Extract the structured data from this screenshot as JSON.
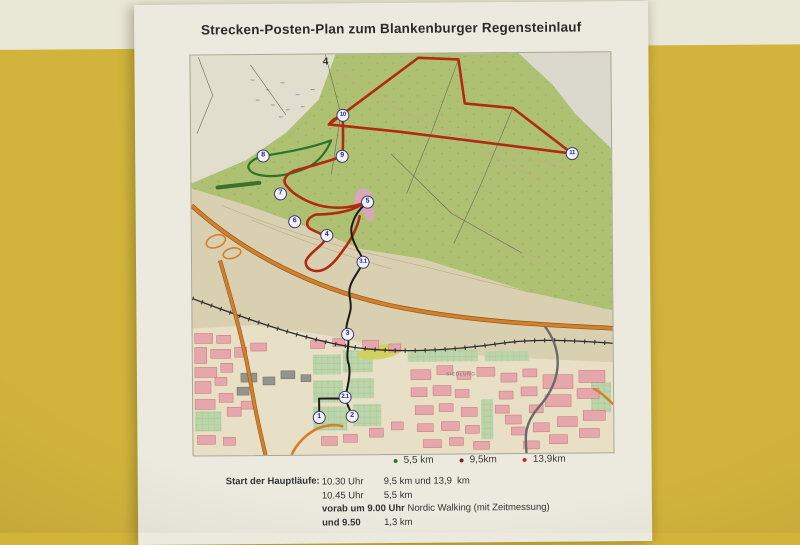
{
  "wall": {
    "band_color": "#e9e7d6",
    "wall_color": "#d2b43c"
  },
  "poster": {
    "title": "Strecken-Posten-Plan zum Blankenburger Regensteinlauf",
    "legend": [
      {
        "label": "5,5 km",
        "color": "#2f7a28"
      },
      {
        "label": "9,5km",
        "color": "#7a2418"
      },
      {
        "label": "13,9km",
        "color": "#c0301c"
      }
    ],
    "schedule": {
      "heading": "Start der Hauptläufe:",
      "rows": [
        {
          "time": "10.30 Uhr",
          "detail": "9,5 km und 13,9  km",
          "bold": false
        },
        {
          "time": "10.45 Uhr",
          "detail": "5,5 km",
          "bold": false
        },
        {
          "time": "vorab um 9.00 Uhr",
          "detail": " Nordic Walking (mit Zeitmessung)",
          "bold": true
        },
        {
          "time": "und 9.50",
          "detail": "1,3 km",
          "bold": true
        }
      ]
    }
  },
  "map": {
    "colors": {
      "forest": "#aec173",
      "open_field": "#e1decd",
      "plain": "#d9d0b2",
      "town_pink": "#e6a7aa",
      "route_long": "#b22a12",
      "route_green": "#2c7427",
      "route_access": "#1b1b1b",
      "highway": "#d57f2a"
    },
    "labels": [
      {
        "text": "4",
        "x": 135,
        "y": 2,
        "style": "grid"
      },
      {
        "text": "SIEDLUNG",
        "x": 268,
        "y": 318,
        "style": "tiny"
      }
    ],
    "checkpoints": [
      {
        "label": "10",
        "x": 152,
        "y": 61
      },
      {
        "label": "8",
        "x": 72,
        "y": 101
      },
      {
        "label": "9",
        "x": 151,
        "y": 102
      },
      {
        "label": "11",
        "x": 381,
        "y": 101
      },
      {
        "label": "7",
        "x": 89,
        "y": 139
      },
      {
        "label": "5",
        "x": 176,
        "y": 148
      },
      {
        "label": "6",
        "x": 103,
        "y": 167
      },
      {
        "label": "4",
        "x": 135,
        "y": 181
      },
      {
        "label": "3.1",
        "x": 171,
        "y": 208
      },
      {
        "label": "3",
        "x": 155,
        "y": 280
      },
      {
        "label": "2.1",
        "x": 152,
        "y": 343
      },
      {
        "label": "1",
        "x": 126,
        "y": 363
      },
      {
        "label": "2",
        "x": 159,
        "y": 362
      }
    ]
  }
}
